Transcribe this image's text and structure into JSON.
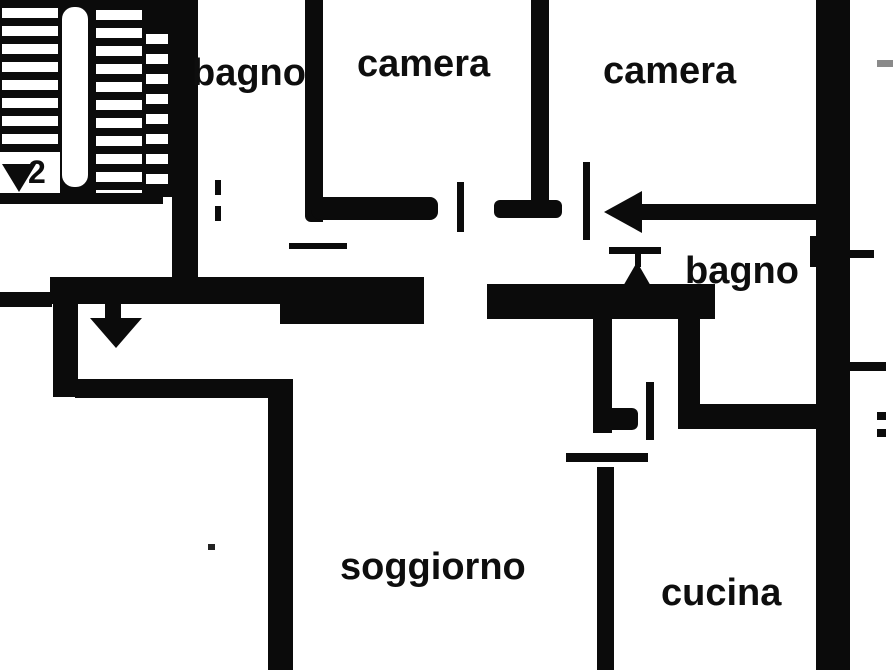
{
  "meta": {
    "kind": "apartment floor plan",
    "canvas": {
      "width": 893,
      "height": 670
    }
  },
  "colors": {
    "ink": "#0b0b0b",
    "paper": "#ffffff"
  },
  "rooms": {
    "bagno_top": {
      "label": "bagno"
    },
    "camera_left": {
      "label": "camera"
    },
    "camera_right": {
      "label": "camera"
    },
    "bagno_right": {
      "label": "bagno"
    },
    "soggiorno": {
      "label": "soggiorno"
    },
    "cucina": {
      "label": "cucina"
    }
  },
  "stairs": {
    "step_number": "2"
  },
  "icons": {
    "entrance_arrow": "left-arrow",
    "hall_arrow": "down-arrow",
    "stairs_arrow": "down-arrow",
    "door_marks": "short tick lines at door openings",
    "window_marks": "short tick lines crossing right outer wall"
  }
}
